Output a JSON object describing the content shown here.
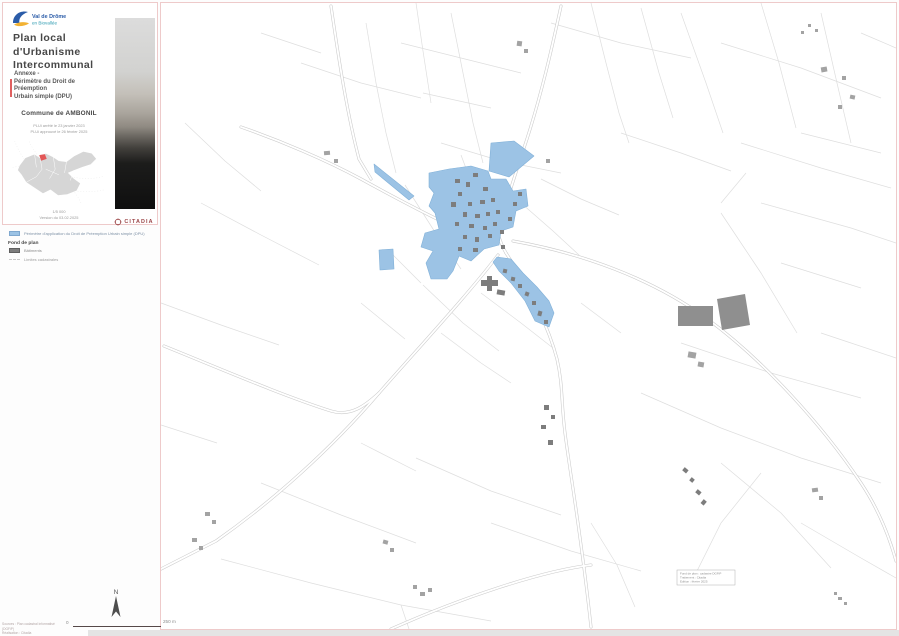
{
  "title_block": {
    "logo": {
      "line1": "Val de Drôme",
      "line2": "en Biovallée"
    },
    "title_lines": [
      "Plan local",
      "d'Urbanisme",
      "Intercommunal"
    ],
    "annexe_lines": [
      "Annexe -",
      "Périmètre du Droit de",
      "Préemption",
      "Urbain simple (DPU)"
    ],
    "commune": "Commune de AMBONIL",
    "approval_line1": "PLUi arrêté le 23 janvier 2023",
    "approval_line2": "PLUi approuvé le 26 février 2025",
    "scale_text": "1/5 000",
    "version_text": "Version du 03.02.2025",
    "author": "CITADIA"
  },
  "legend": {
    "dpu_label": "Périmètre d'application du Droit de Préemption Urbain simple (DPU)",
    "fond_heading": "Fond de plan",
    "batiments_label": "Bâtiments",
    "limites_label": "Limites cadastrales"
  },
  "map": {
    "north_label": "N",
    "scalebar_zero": "0",
    "scalebar_max": "250 m",
    "attribution_line1": "Sources : Plan cadastral informatisé (DGFiP)",
    "attribution_line2": "Réalisation : Citadia",
    "credit_box_line1": "Fond de plan : cadastre DGFiP",
    "credit_box_line2": "Traitement : Citadia",
    "credit_box_line3": "Edition : février 2025"
  },
  "colors": {
    "dpu_fill": "#9CC3E5",
    "dpu_stroke": "#82B1D8",
    "building_fill": "#7D7D7D",
    "building_light": "#A3A3A3",
    "parcel_line": "#DEDEDE",
    "road_line": "#C9C9C9",
    "accent_red": "#E06060",
    "frame_pink": "#EECACA",
    "citadia_red": "#9C4648",
    "logo_blue": "#2B5CA8",
    "logo_yellow": "#F2B233"
  }
}
